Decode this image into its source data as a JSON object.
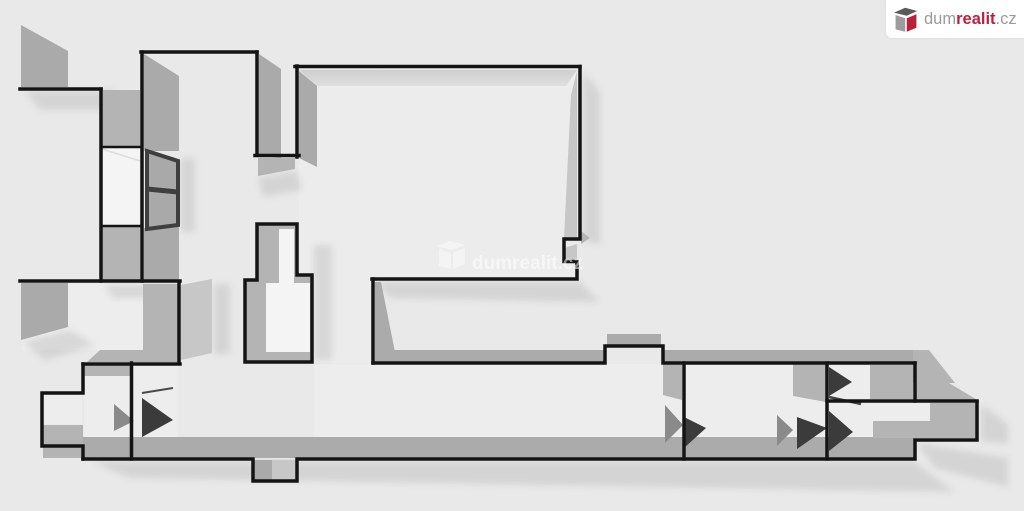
{
  "page": {
    "title": "3D floor plan preview",
    "background_color": "#e9e9e9"
  },
  "logo": {
    "brand_part_1": "dum",
    "brand_part_2": "realit",
    "brand_part_3": ".cz",
    "icon": "dumrealit-cube-icon",
    "card_color": "#ffffff",
    "gray_text_color": "#9a9a9a",
    "red_text_color": "#bf1f3d"
  },
  "watermark": {
    "text": "dumrealit.cz",
    "icon": "dumrealit-cube-icon",
    "color": "#ffffff",
    "opacity": 0.5
  },
  "floorplan": {
    "wall_outline_color": "#141414",
    "wall_face_color": "#aaaaaa",
    "wall_face_light_color": "#c7c7c7",
    "floor_color": "#ededed",
    "door_leaf_color": "#3b3b3b",
    "window_frame_color": "#3f3f3f",
    "window_pane_color": "#f4f4f4",
    "shadow_opacity": 0.09
  }
}
